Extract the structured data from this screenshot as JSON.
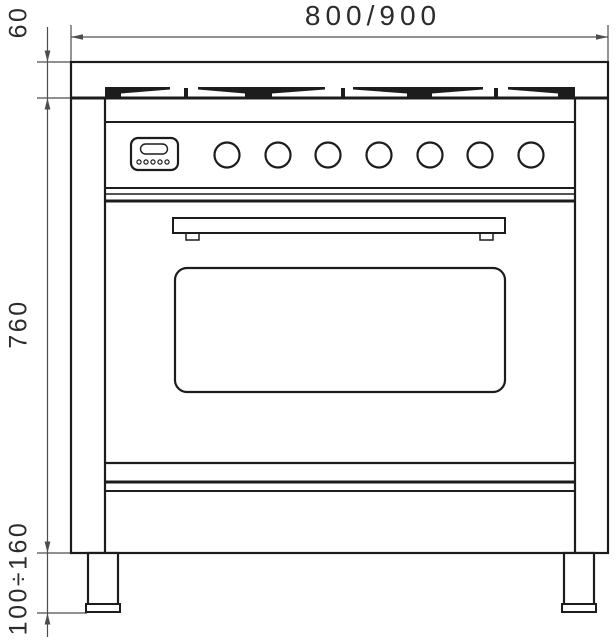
{
  "diagram": {
    "type": "technical-dimension-drawing",
    "subject": "range-cooker-front-elevation",
    "dimension_labels": {
      "width": "800/900",
      "cooktop_height": "60",
      "body_height": "760",
      "leg_height": "100÷160"
    },
    "colors": {
      "background": "#ffffff",
      "drawing_line": "#1c1c1c",
      "dimension_line": "#4d4d4d",
      "label_text": "#2b2b2b"
    },
    "features": {
      "knob_count": 7,
      "display_dot_count": 5,
      "grate_section_count": 4,
      "leg_count": 2
    }
  }
}
